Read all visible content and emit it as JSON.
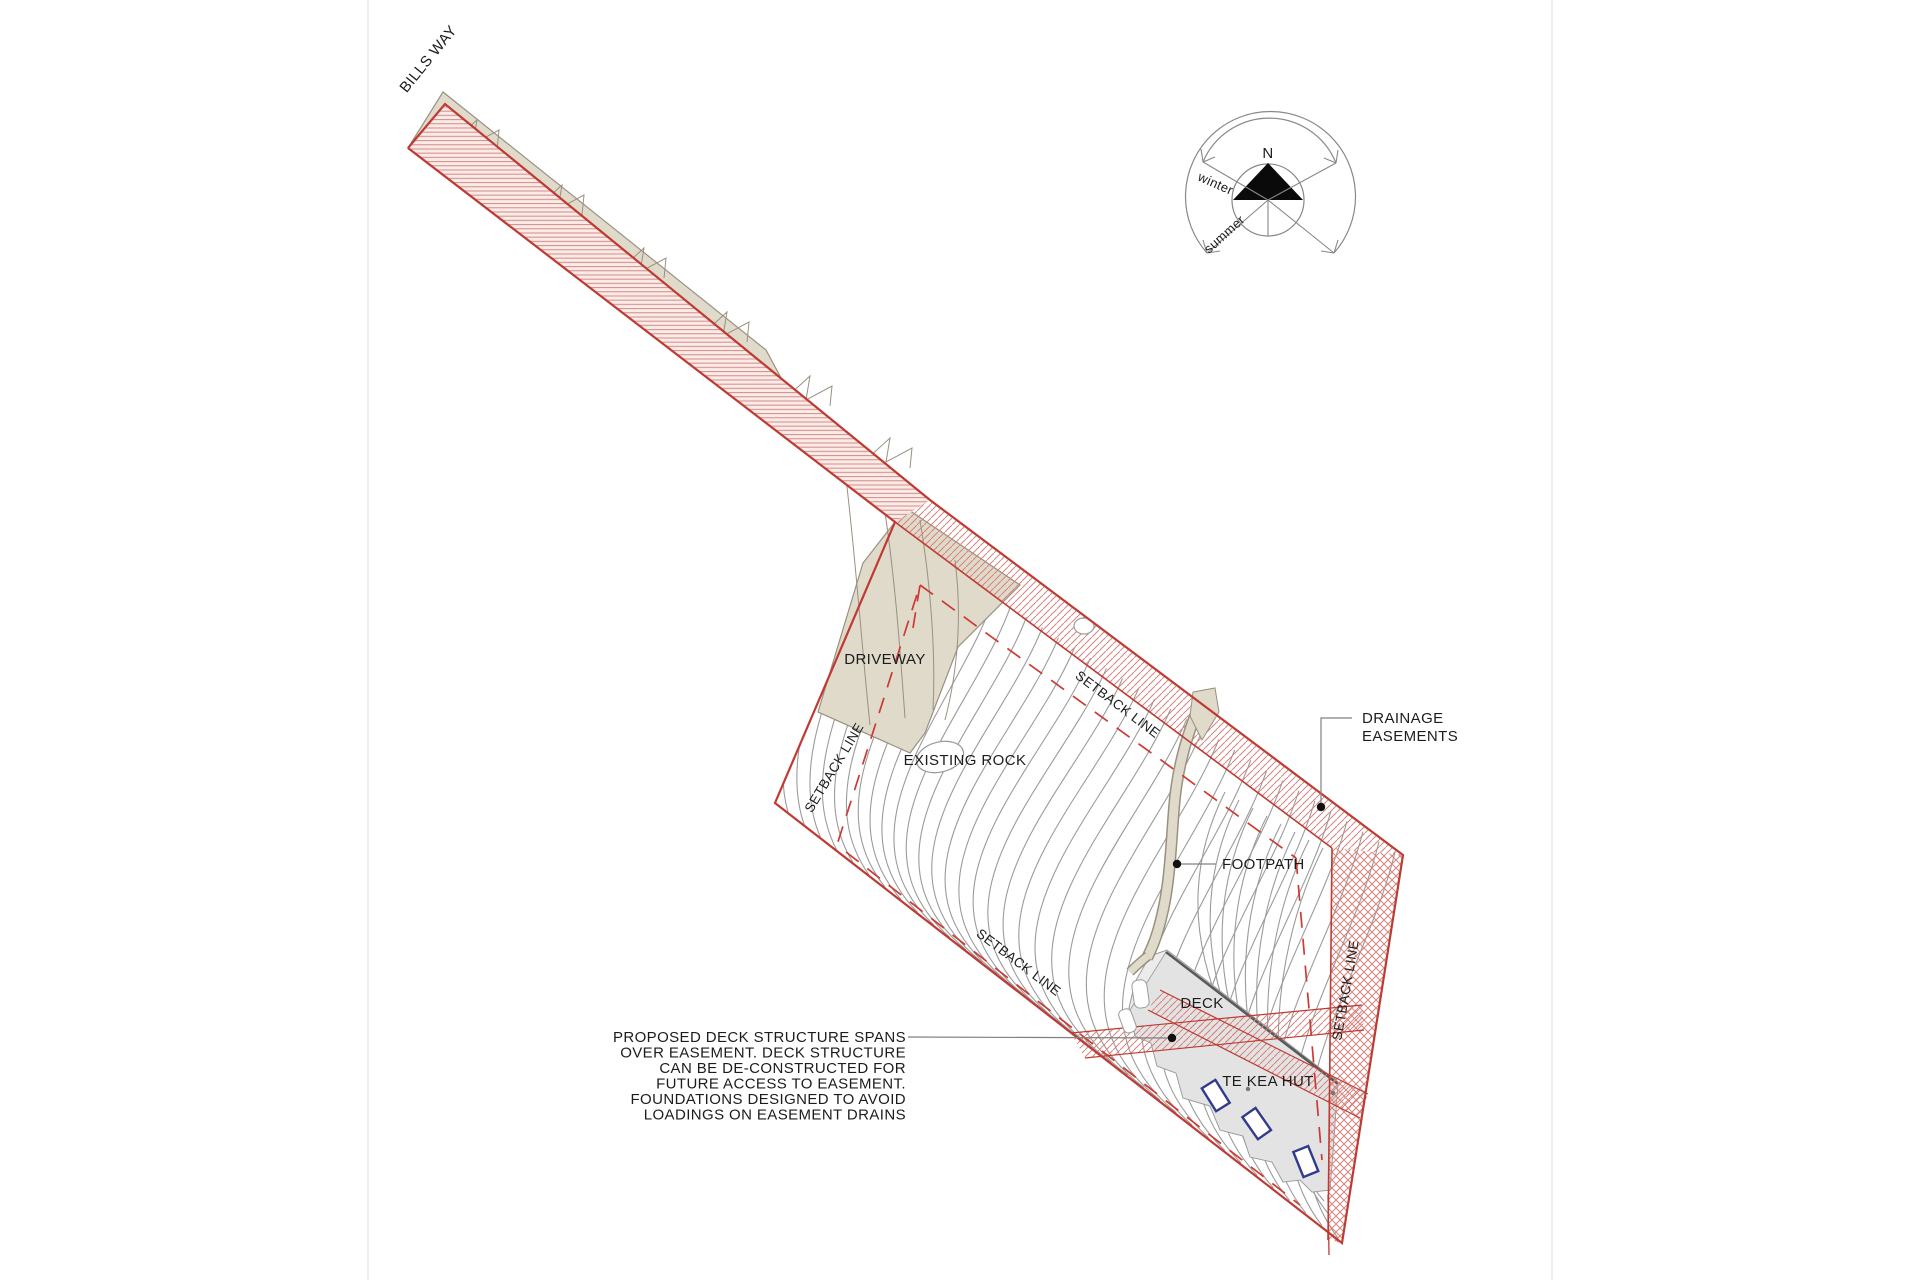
{
  "drawing_title": "Site plan — Te Kea Hut",
  "road": {
    "name_label": "BILLS WAY"
  },
  "compass": {
    "north_label": "N",
    "winter_label": "winter",
    "summer_label": "summer"
  },
  "site_labels": {
    "driveway": "DRIVEWAY",
    "existing_rock": "EXISTING ROCK",
    "setback_line": "SETBACK LINE",
    "drainage_easements_line1": "DRAINAGE",
    "drainage_easements_line2": "EASEMENTS",
    "footpath": "FOOTPATH",
    "deck": "DECK",
    "hut": "TE KEA HUT"
  },
  "annotation": {
    "lines": [
      "PROPOSED DECK STRUCTURE SPANS",
      "OVER EASEMENT. DECK STRUCTURE",
      "CAN BE DE-CONSTRUCTED FOR",
      "FUTURE ACCESS TO EASEMENT.",
      "FOUNDATIONS DESIGNED TO AVOID",
      "LOADINGS ON EASEMENT DRAINS"
    ]
  },
  "colors": {
    "ink": "#1c1c1c",
    "boundary_red": "#bf3a33",
    "hatch_red": "#d4837d",
    "dash_red": "#cc3a33",
    "pink_tint": "#f8ebe8",
    "beige": "#e0dacb",
    "beige_stroke": "#99917f",
    "contour_gray": "#9b9b9b",
    "deck_gray": "#ececec",
    "hut_gray": "#e3e3e3",
    "ridge_gray": "#5a5a5a",
    "navy": "#333a8c",
    "leader_gray": "#808080",
    "guide_gray": "#dedede",
    "north_black": "#0a0a0a"
  }
}
